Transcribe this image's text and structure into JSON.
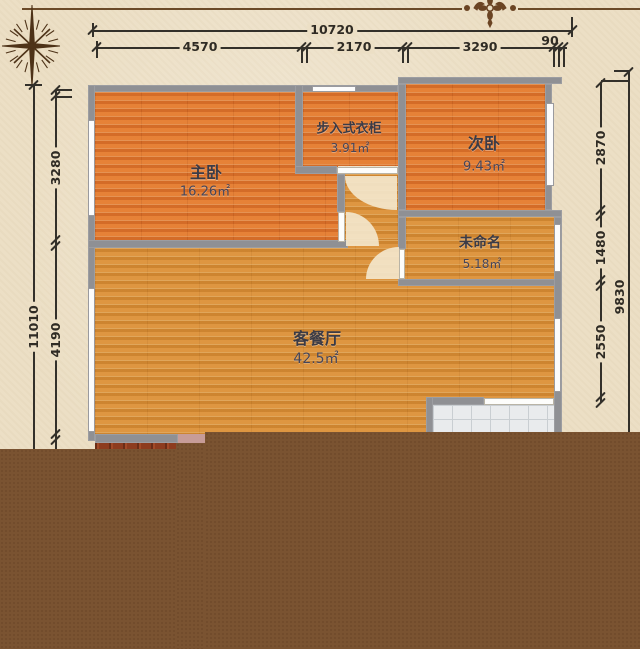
{
  "ornament": {
    "divider": "damask-flourish"
  },
  "compass": {
    "icon": "compass-rose"
  },
  "dims": {
    "top_total": "10720",
    "top_seg1": "4570",
    "top_seg2": "2170",
    "top_seg3": "3290",
    "top_seg4": "90",
    "left_total": "11010",
    "left_seg1": "3280",
    "left_seg2": "4190",
    "right_total": "9830",
    "right_seg1": "2870",
    "right_seg2": "1480",
    "right_seg3": "2550"
  },
  "rooms": {
    "master": {
      "name": "主卧",
      "area": "16.26㎡"
    },
    "closet": {
      "name": "步入式衣柜",
      "area": "3.91㎡"
    },
    "second": {
      "name": "次卧",
      "area": "9.43㎡"
    },
    "unnamed": {
      "name": "未命名",
      "area": "5.18㎡"
    },
    "living": {
      "name": "客餐厅",
      "area": "42.5㎡"
    }
  },
  "colors": {
    "background": "#ecdfc5",
    "wall": "#8f9094",
    "bedroom_floor": "#e0762e",
    "living_floor": "#d78d37",
    "tile_floor": "#e9ebed",
    "unrendered_overlay": "#7a5331",
    "dimension_ink": "#33302a",
    "label_ink": "#3b3b46"
  }
}
